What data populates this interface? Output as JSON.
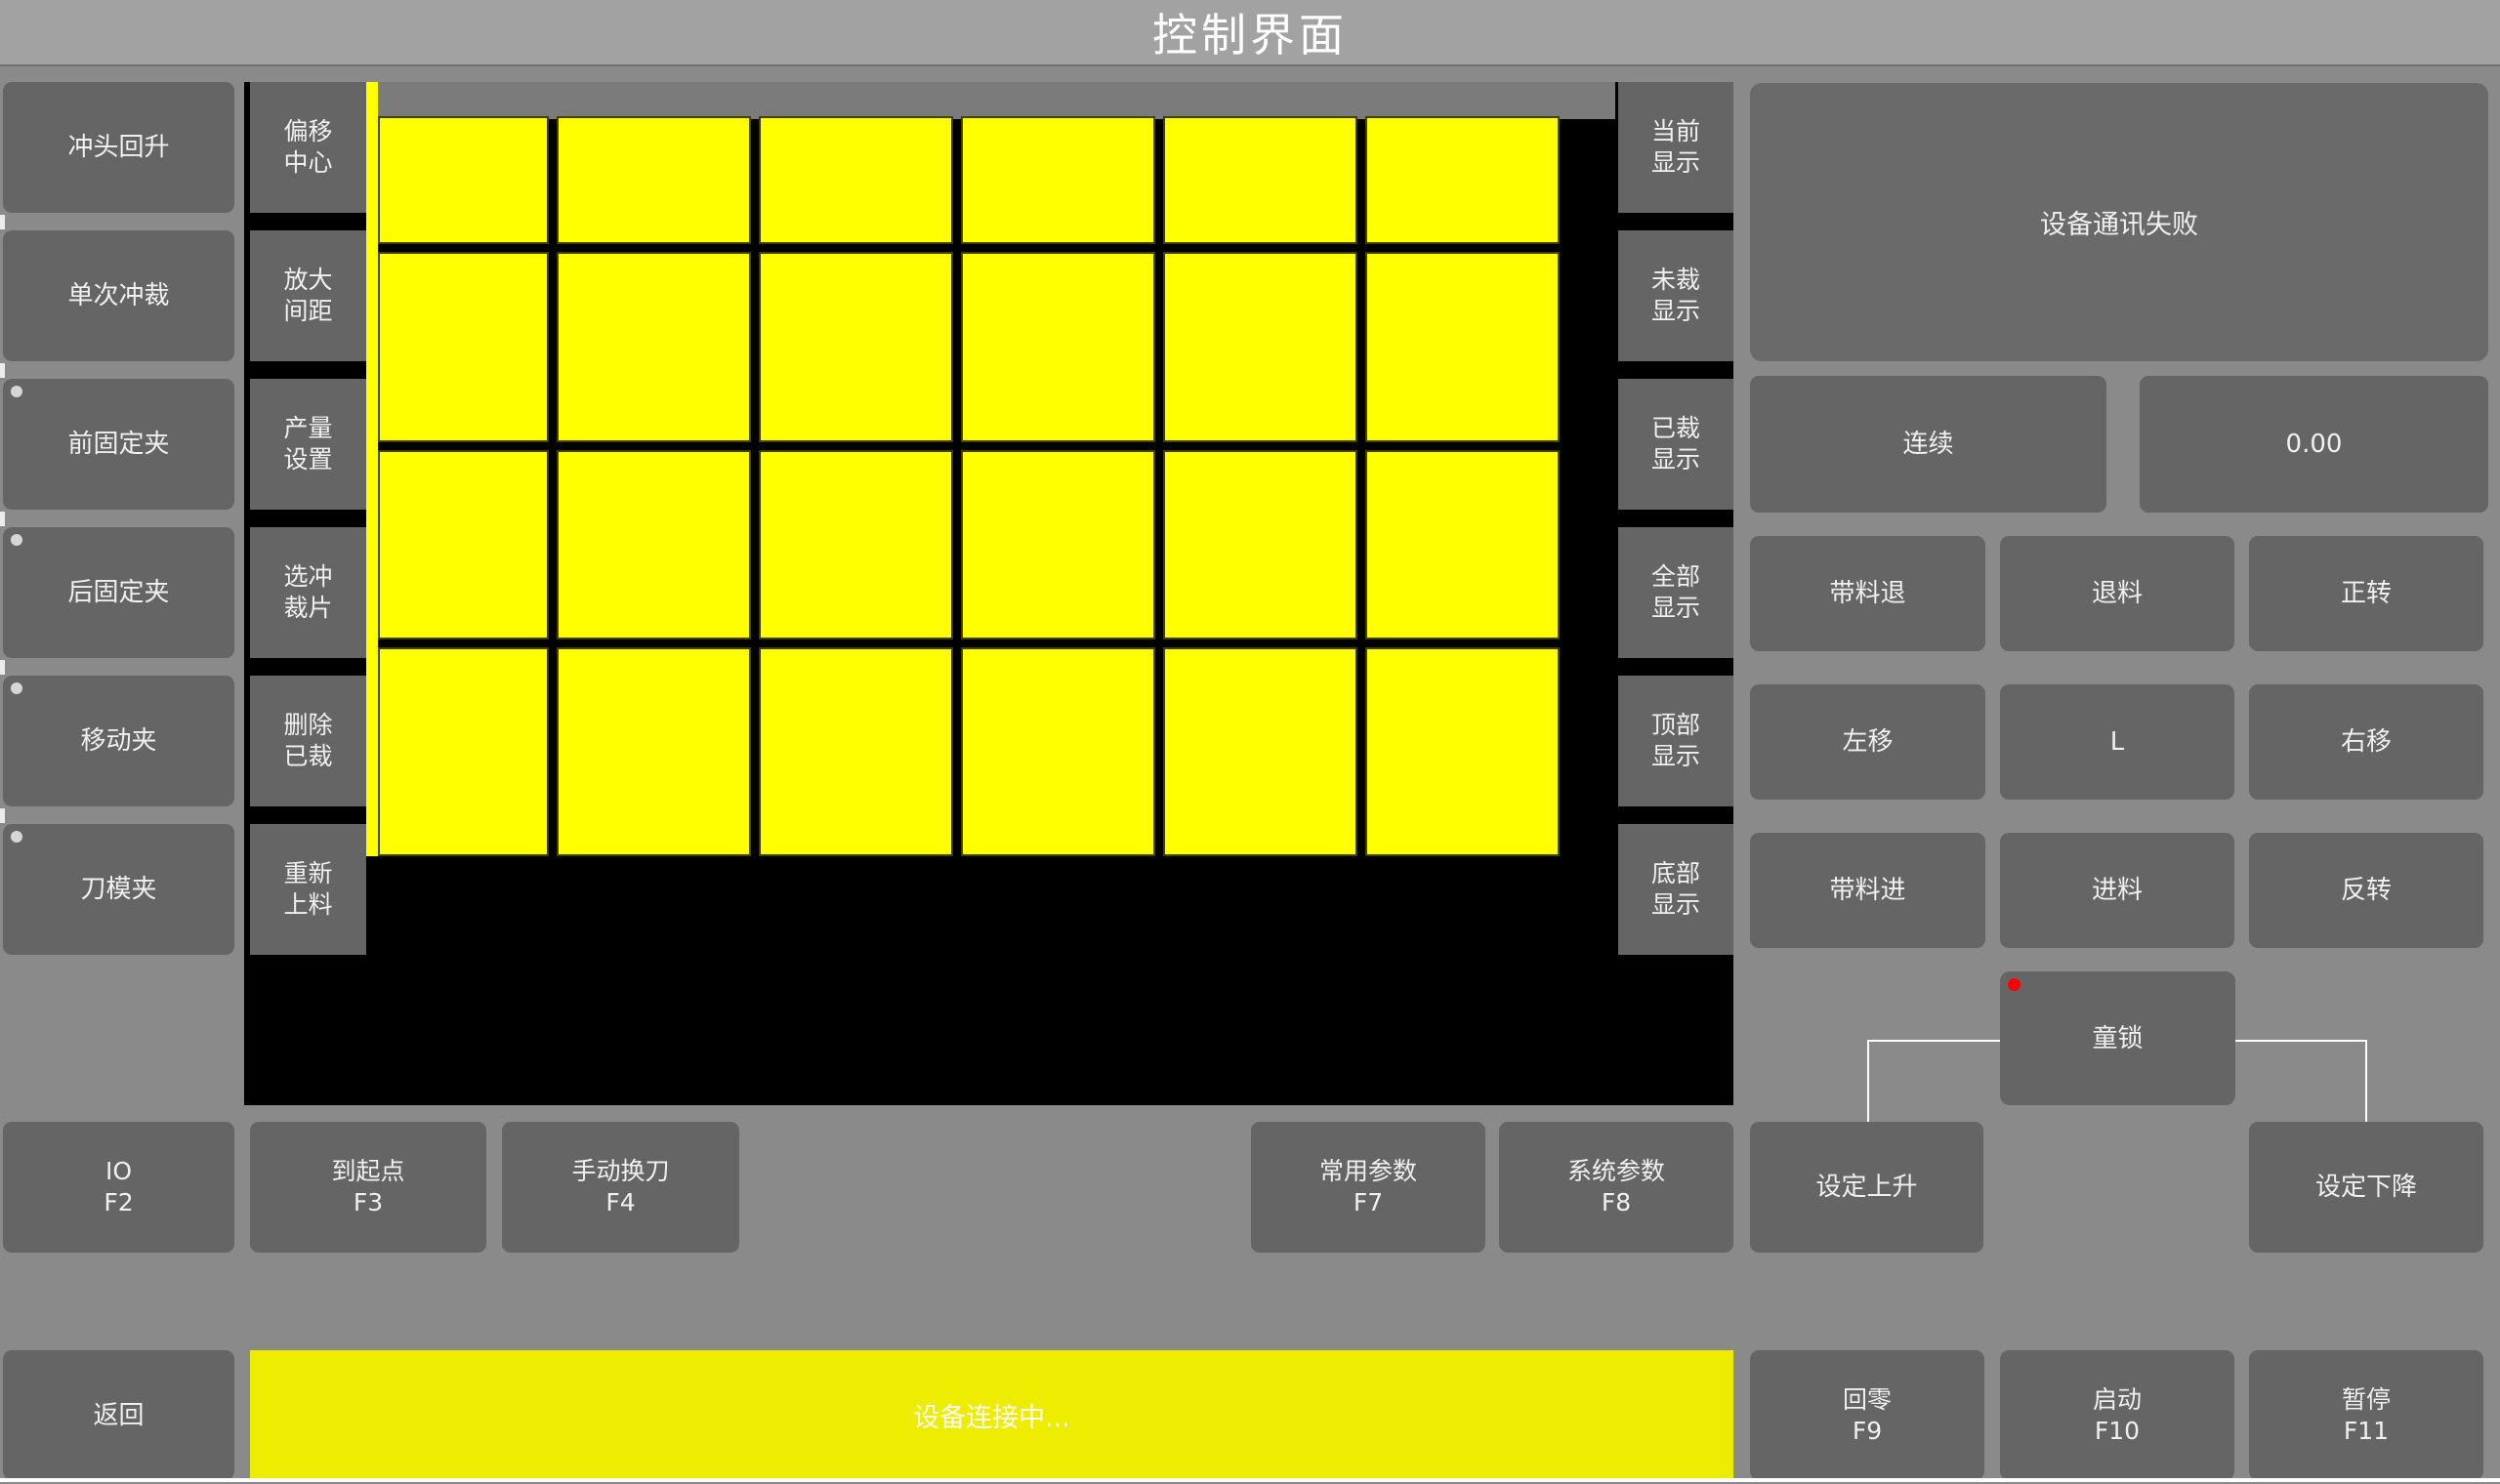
{
  "title": "控制界面",
  "left_column": {
    "items": [
      {
        "label": "冲头回升",
        "indicator": false
      },
      {
        "label": "单次冲裁",
        "indicator": false
      },
      {
        "label": "前固定夹",
        "indicator": true
      },
      {
        "label": "后固定夹",
        "indicator": true
      },
      {
        "label": "移动夹",
        "indicator": true
      },
      {
        "label": "刀模夹",
        "indicator": true
      }
    ]
  },
  "tool_column": {
    "items": [
      {
        "line1": "偏移",
        "line2": "中心"
      },
      {
        "line1": "放大",
        "line2": "间距"
      },
      {
        "line1": "产量",
        "line2": "设置"
      },
      {
        "line1": "选冲",
        "line2": "裁片"
      },
      {
        "line1": "删除",
        "line2": "已裁"
      },
      {
        "line1": "重新",
        "line2": "上料"
      }
    ]
  },
  "display_column": {
    "items": [
      {
        "line1": "当前",
        "line2": "显示"
      },
      {
        "line1": "未裁",
        "line2": "显示"
      },
      {
        "line1": "已裁",
        "line2": "显示"
      },
      {
        "line1": "全部",
        "line2": "显示"
      },
      {
        "line1": "顶部",
        "line2": "显示"
      },
      {
        "line1": "底部",
        "line2": "显示"
      }
    ]
  },
  "canvas": {
    "grid_rows": 4,
    "grid_cols": 6,
    "sheet_color": "#ffff00",
    "background_color": "#000000"
  },
  "status_panel": {
    "message": "设备通讯失败",
    "mode_label": "连续",
    "value": "0.00"
  },
  "jog_grid": {
    "buttons": [
      "带料退",
      "退料",
      "正转",
      "左移",
      "L",
      "右移",
      "带料进",
      "进料",
      "反转"
    ]
  },
  "child_lock": {
    "label": "童锁",
    "indicator_color": "#ff0000"
  },
  "function_row": {
    "items": [
      {
        "label": "IO",
        "fkey": "F2"
      },
      {
        "label": "到起点",
        "fkey": "F3"
      },
      {
        "label": "手动换刀",
        "fkey": "F4"
      },
      {
        "label": "常用参数",
        "fkey": "F7"
      },
      {
        "label": "系统参数",
        "fkey": "F8"
      }
    ],
    "set_up_label": "设定上升",
    "set_down_label": "设定下降"
  },
  "bottom_bar": {
    "back_label": "返回",
    "status_message": "设备连接中...",
    "buttons": [
      {
        "label": "回零",
        "fkey": "F9"
      },
      {
        "label": "启动",
        "fkey": "F10"
      },
      {
        "label": "暂停",
        "fkey": "F11"
      }
    ]
  }
}
